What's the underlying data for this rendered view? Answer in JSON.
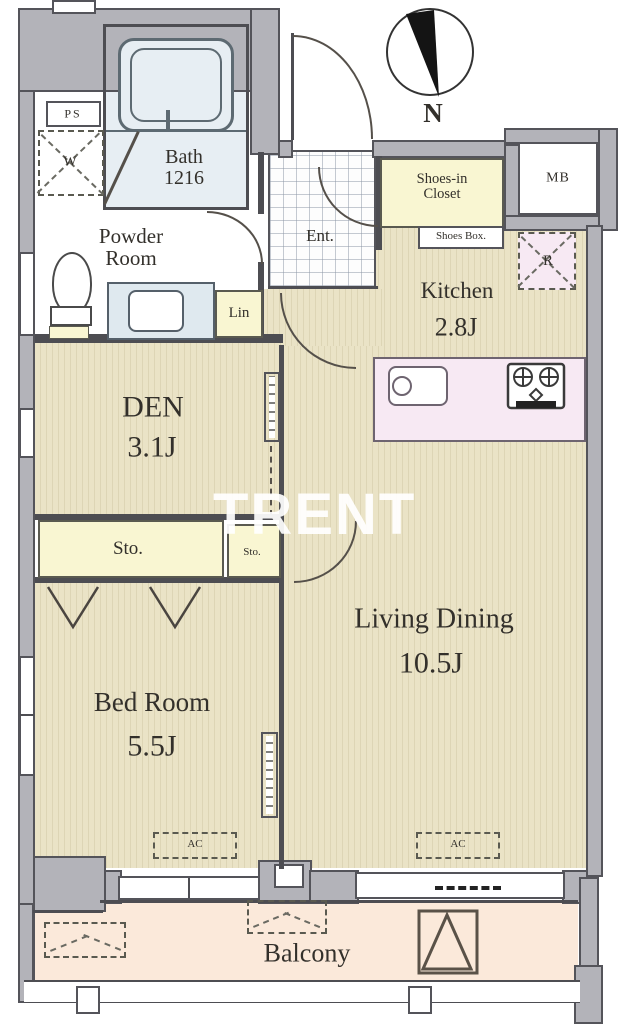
{
  "watermark_text": "TRENT",
  "compass": {
    "north_label": "N"
  },
  "rooms": {
    "bath": {
      "name": "Bath",
      "size": "1216"
    },
    "powder": {
      "line1": "Powder",
      "line2": "Room"
    },
    "den": {
      "name": "DEN",
      "size": "3.1J"
    },
    "bedroom": {
      "name": "Bed Room",
      "size": "5.5J"
    },
    "living": {
      "name": "Living Dining",
      "size": "10.5J"
    },
    "kitchen": {
      "name": "Kitchen",
      "size": "2.8J"
    },
    "entrance": {
      "name": "Ent."
    },
    "balcony": {
      "name": "Balcony"
    }
  },
  "storage": {
    "shoes_in_closet_line1": "Shoes-in",
    "shoes_in_closet_line2": "Closet",
    "shoes_box": "Shoes Box.",
    "storage_large": "Sto.",
    "storage_small": "Sto.",
    "linen": "Lin",
    "pipe_space": "PS",
    "meter_box": "MB"
  },
  "equipment": {
    "washer": "W",
    "refrigerator": "R",
    "ac_bedroom": "AC",
    "ac_living": "AC"
  },
  "colors": {
    "floor_wood": "#eae3c6",
    "floor_stripe": "#ddd5b5",
    "wall_gray": "#b3b3b9",
    "wall_line": "#4d4d52",
    "closet_yellow": "#f9f6d2",
    "counter_pink": "#f7e9f3",
    "balcony_peach": "#fbe9da",
    "bath_blue": "#e7eef3",
    "text_dark": "#33302b"
  }
}
